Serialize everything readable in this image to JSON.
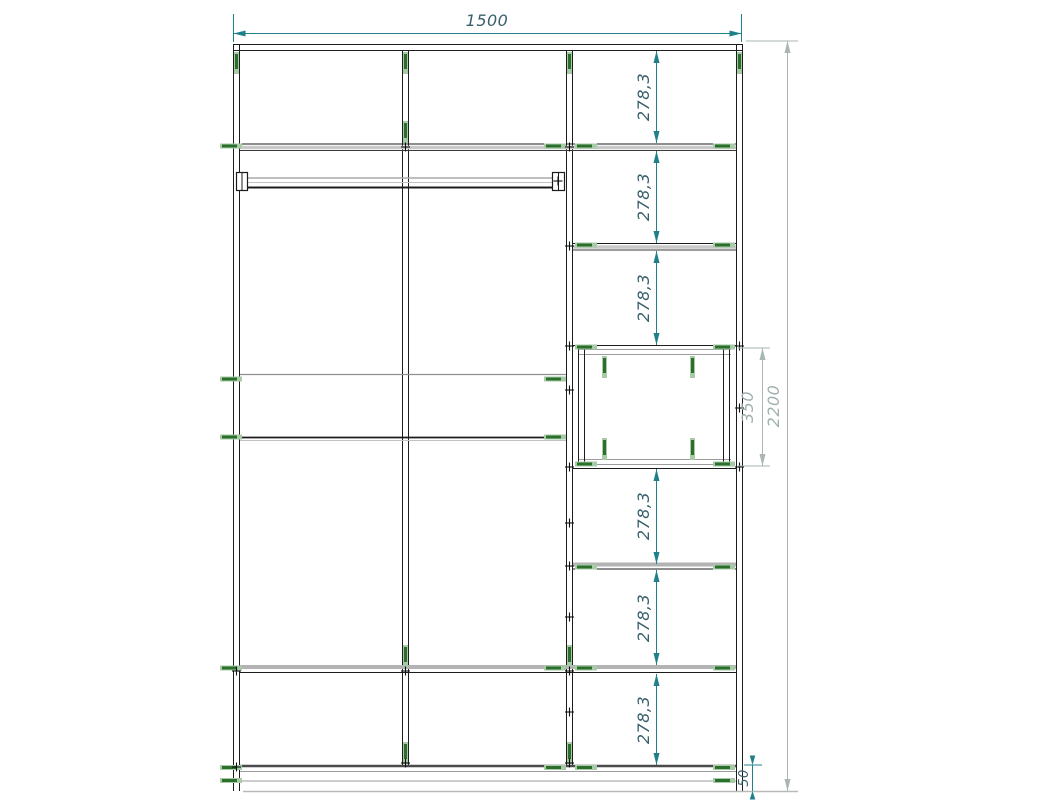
{
  "drawing": {
    "dim_total_width": "1500",
    "dim_total_height": "2200",
    "dim_compartment_height": "350",
    "dim_plinth_height": "50",
    "dim_shelf_spacings": [
      "278,3",
      "278,3",
      "278,3",
      "278,3",
      "278,3",
      "278,3"
    ]
  },
  "colors": {
    "dim_teal_line": "#1f8089",
    "dim_teal_text": "#38606b",
    "dim_gray_line": "#aab6b4",
    "dim_gray_text": "#9fafae",
    "screw_green_dark": "#2c6f2c",
    "screw_green_light": "#a6cba6",
    "outline_black": "#1c1c1c",
    "edge_gray": "#9b9b9b",
    "background": "#ffffff"
  }
}
